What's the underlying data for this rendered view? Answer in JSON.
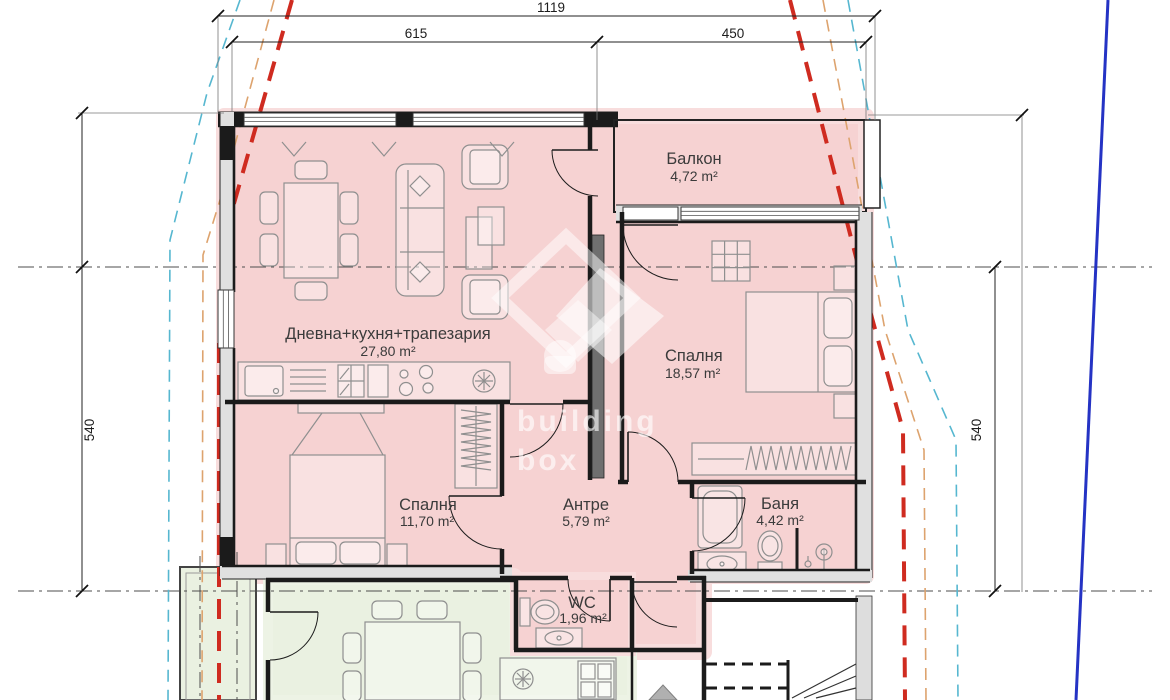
{
  "drawing": {
    "dimensions": {
      "top_total": "1119",
      "top_left_segment": "615",
      "top_right_segment": "450",
      "left_height": "540",
      "right_height": "540"
    },
    "rooms": {
      "balcony": {
        "name": "Балкон",
        "area": "4,72 m²"
      },
      "living": {
        "name": "Дневна+кухня+трапезария",
        "area": "27,80 m²"
      },
      "bedroom_large": {
        "name": "Спалня",
        "area": "18,57 m²"
      },
      "bedroom_small": {
        "name": "Спалня",
        "area": "11,70 m²"
      },
      "hallway": {
        "name": "Антре",
        "area": "5,79 m²"
      },
      "bathroom": {
        "name": "Баня",
        "area": "4,42 m²"
      },
      "wc": {
        "name": "WC",
        "area": "1,96 m²"
      }
    },
    "watermark": {
      "line1": "building",
      "line2": "box"
    },
    "colors": {
      "apartment_highlight": "#f6d2d2",
      "apartment_glow": "#f8dddd",
      "neighbor_highlight": "#eaf1e1",
      "line_red": "#cf2b20",
      "line_orange": "#dda36e",
      "line_cyan": "#56b7d0",
      "line_blue": "#2533c4"
    }
  }
}
